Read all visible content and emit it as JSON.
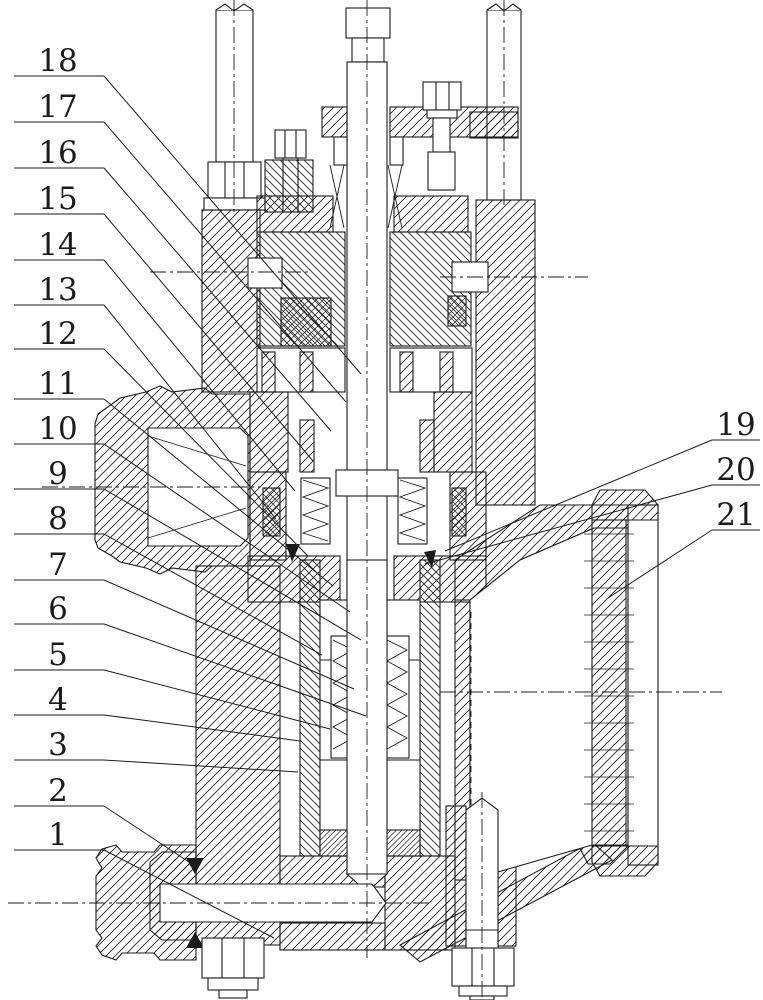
{
  "drawing": {
    "title": "valve-assembly-sectional-drawing",
    "description": "Patent-style cross-sectional assembly drawing of a spring-loaded valve with numbered part callouts",
    "background_color": "#ffffff",
    "line_color": "#1b1b1b",
    "part_numbers_visible": [
      "1",
      "2",
      "3",
      "4",
      "5",
      "6",
      "7",
      "8",
      "9",
      "10",
      "11",
      "12",
      "13",
      "14",
      "15",
      "16",
      "17",
      "18",
      "19",
      "20",
      "21"
    ]
  },
  "callouts": {
    "left_start_x": 104,
    "left_underline_x1": 14,
    "right_start_x": 712,
    "right_underline_x2": 760,
    "left": [
      {
        "n": "18",
        "cy": 60,
        "uy": 76,
        "tx": 361,
        "ty": 374
      },
      {
        "n": "17",
        "cy": 106,
        "uy": 122,
        "tx": 346,
        "ty": 402
      },
      {
        "n": "16",
        "cy": 152,
        "uy": 168,
        "tx": 331,
        "ty": 431
      },
      {
        "n": "15",
        "cy": 198,
        "uy": 214,
        "tx": 313,
        "ty": 461
      },
      {
        "n": "14",
        "cy": 244,
        "uy": 260,
        "tx": 295,
        "ty": 491
      },
      {
        "n": "13",
        "cy": 289,
        "uy": 305,
        "tx": 276,
        "ty": 519
      },
      {
        "n": "12",
        "cy": 333,
        "uy": 349,
        "tx": 308,
        "ty": 556
      },
      {
        "n": "11",
        "cy": 383,
        "uy": 399,
        "tx": 333,
        "ty": 586
      },
      {
        "n": "10",
        "cy": 428,
        "uy": 444,
        "tx": 350,
        "ty": 612
      },
      {
        "n": "9",
        "cy": 473,
        "uy": 489,
        "tx": 361,
        "ty": 640
      },
      {
        "n": "8",
        "cy": 518,
        "uy": 534,
        "tx": 322,
        "ty": 655
      },
      {
        "n": "7",
        "cy": 564,
        "uy": 580,
        "tx": 354,
        "ty": 689
      },
      {
        "n": "6",
        "cy": 608,
        "uy": 624,
        "tx": 366,
        "ty": 716
      },
      {
        "n": "5",
        "cy": 654,
        "uy": 670,
        "tx": 330,
        "ty": 729
      },
      {
        "n": "4",
        "cy": 699,
        "uy": 715,
        "tx": 300,
        "ty": 741
      },
      {
        "n": "3",
        "cy": 744,
        "uy": 760,
        "tx": 298,
        "ty": 772
      },
      {
        "n": "2",
        "cy": 790,
        "uy": 806,
        "tx": 198,
        "ty": 868
      },
      {
        "n": "1",
        "cy": 834,
        "uy": 850,
        "tx": 274,
        "ty": 938
      }
    ],
    "right": [
      {
        "n": "19",
        "cy": 424,
        "uy": 440,
        "tx": 445,
        "ty": 551
      },
      {
        "n": "20",
        "cy": 469,
        "uy": 485,
        "tx": 425,
        "ty": 564
      },
      {
        "n": "21",
        "cy": 514,
        "uy": 530,
        "tx": 608,
        "ty": 598
      }
    ]
  }
}
